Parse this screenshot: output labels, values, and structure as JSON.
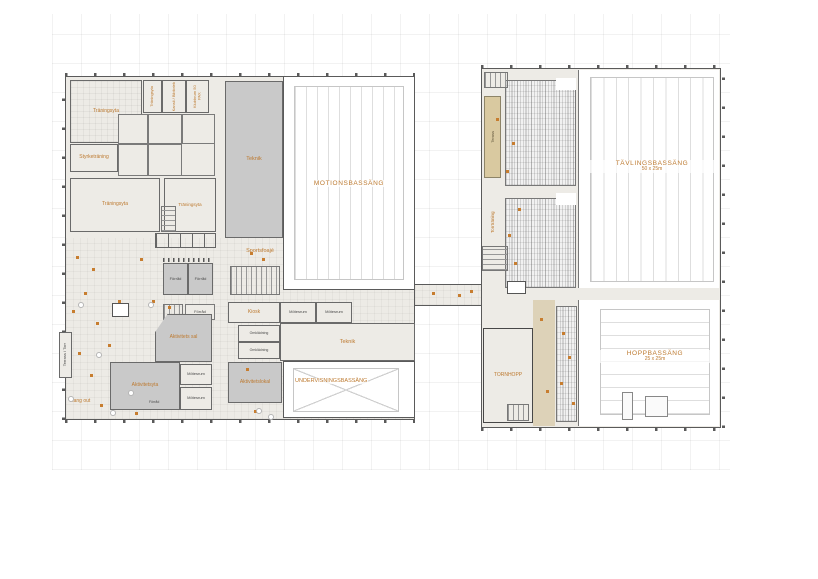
{
  "doc": {
    "type": "swim-hall-floor-plan"
  },
  "colors": {
    "accent": "#bd7a30",
    "room_fill": "#c9c9c9",
    "terrace_fill": "#d9c9a0",
    "floor_fill": "#edebe6",
    "wall": "#5a5a5a"
  },
  "labels": {
    "traningsyta_nw": "Träningsyta",
    "traningsyta_top": "Träningsyta",
    "kansli_bibliotek": "Kansli / Bibliotek",
    "klubbrum": "Klubbrum 50 PAX",
    "styrketraning": "Styrketräning",
    "traningsyta_w": "Träningsyta",
    "traningsyta_s": "Träningsyta",
    "teknik_nord": "Teknik",
    "sportsfoaje": "Sportsfoajé",
    "motionsbassang": "MOTIONSBASSÄNG",
    "forrad_a": "Förråd",
    "forrad_b": "Förråd",
    "forrad_c": "Förråd",
    "forrad_d": "Förråd",
    "kiosk": "Kiosk",
    "motesrum_a": "Mötesrum",
    "motesrum_b": "Mötesrum",
    "motesrum_c": "Mötesrum",
    "motesrum_d": "Mötesrum",
    "teknik_syd": "Teknik",
    "omkladning_a": "Omklädning",
    "omkladning_b": "Omklädning",
    "aktivitetslokal": "Aktivitetslokal",
    "undervisningsbassang": "UNDERVISNINGSBASSÄNG",
    "aktivitets_sal": "Aktivitets sal",
    "aktivitetsyta": "Aktivitetsyta",
    "terrass_torr": "Terrass / Torr",
    "hang_out": "Hang out",
    "terass": "Terass",
    "torrtraning": "Torrträning",
    "tavlingsbassang": "TÄVLINGSBASSÄNG",
    "tavlingsbassang_dim": "50 x 25m",
    "hoppbassang": "HOPPBASSÄNG",
    "hoppbassang_dim": "25 x 25m",
    "tornhopp": "TORNHOPP"
  },
  "markers": [
    [
      76,
      256
    ],
    [
      92,
      268
    ],
    [
      84,
      292
    ],
    [
      72,
      310
    ],
    [
      96,
      322
    ],
    [
      108,
      344
    ],
    [
      78,
      352
    ],
    [
      90,
      374
    ],
    [
      118,
      300
    ],
    [
      140,
      258
    ],
    [
      152,
      300
    ],
    [
      168,
      306
    ],
    [
      250,
      252
    ],
    [
      262,
      258
    ],
    [
      246,
      368
    ],
    [
      254,
      410
    ],
    [
      100,
      404
    ],
    [
      135,
      412
    ],
    [
      432,
      292
    ],
    [
      458,
      294
    ],
    [
      470,
      290
    ],
    [
      496,
      118
    ],
    [
      512,
      142
    ],
    [
      506,
      170
    ],
    [
      518,
      208
    ],
    [
      508,
      234
    ],
    [
      514,
      262
    ],
    [
      540,
      318
    ],
    [
      546,
      390
    ],
    [
      562,
      332
    ],
    [
      568,
      356
    ],
    [
      560,
      382
    ],
    [
      572,
      402
    ]
  ],
  "plants": [
    [
      78,
      302
    ],
    [
      96,
      352
    ],
    [
      128,
      390
    ],
    [
      68,
      396
    ],
    [
      110,
      410
    ],
    [
      256,
      408
    ],
    [
      268,
      414
    ],
    [
      148,
      302
    ]
  ]
}
